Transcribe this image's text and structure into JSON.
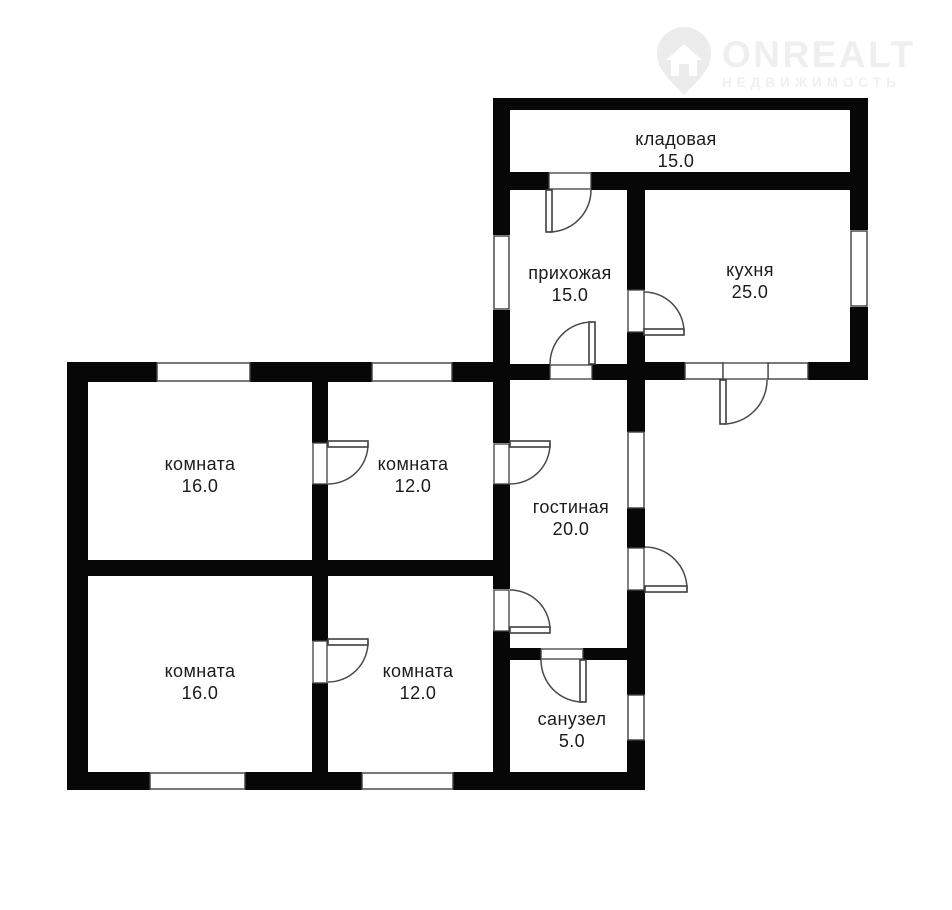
{
  "logo": {
    "brand": "ONREALT",
    "tagline": "НЕДВИЖИМОСТЬ",
    "icon": "map-pin-house-icon"
  },
  "rooms": [
    {
      "id": "kladovaya",
      "label": "кладовая",
      "area": "15.0"
    },
    {
      "id": "prihozhaya",
      "label": "прихожая",
      "area": "15.0"
    },
    {
      "id": "kuhnya",
      "label": "кухня",
      "area": "25.0"
    },
    {
      "id": "komnata-top-left",
      "label": "комната",
      "area": "16.0"
    },
    {
      "id": "komnata-top-right",
      "label": "комната",
      "area": "12.0"
    },
    {
      "id": "gostinaya",
      "label": "гостиная",
      "area": "20.0"
    },
    {
      "id": "komnata-bottom-left",
      "label": "комната",
      "area": "16.0"
    },
    {
      "id": "komnata-bottom-right",
      "label": "комната",
      "area": "12.0"
    },
    {
      "id": "sanuzel",
      "label": "санузел",
      "area": "5.0"
    }
  ],
  "colors": {
    "wall": "#070707",
    "background": "#ffffff",
    "door_window_stroke": "#3f3f3f",
    "label_text": "#1b1b1b",
    "watermark": "#efefef"
  }
}
